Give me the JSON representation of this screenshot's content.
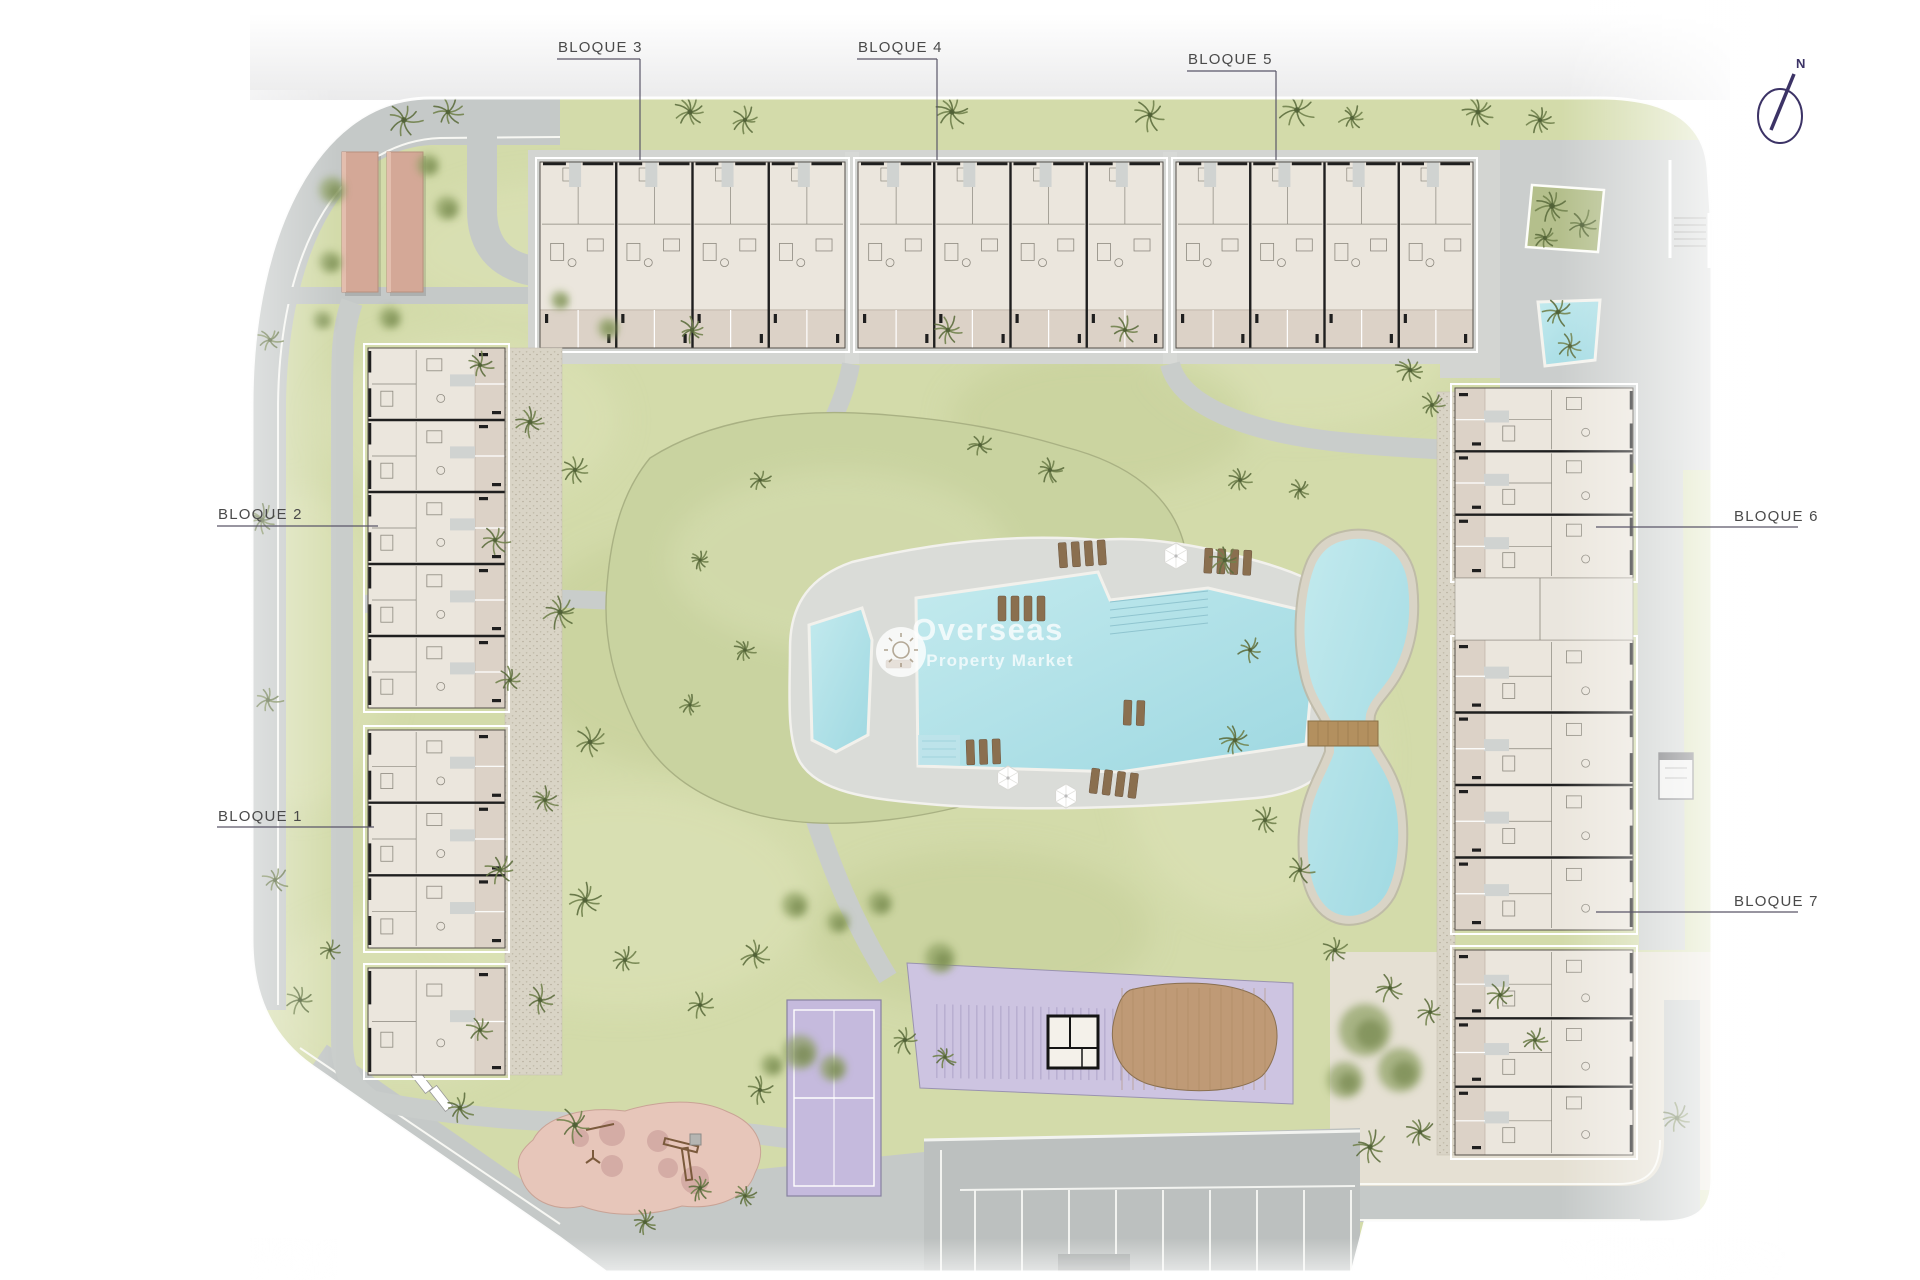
{
  "site_plan": {
    "title": "Residential development site plan",
    "block_labels": [
      {
        "id": "bloque-3",
        "text": "BLOQUE 3",
        "tx": 558,
        "ty": 52,
        "line": [
          557,
          59,
          640,
          59
        ],
        "drop": [
          640,
          59,
          640,
          160
        ]
      },
      {
        "id": "bloque-4",
        "text": "BLOQUE 4",
        "tx": 858,
        "ty": 52,
        "line": [
          857,
          59,
          937,
          59
        ],
        "drop": [
          937,
          59,
          937,
          160
        ]
      },
      {
        "id": "bloque-5",
        "text": "BLOQUE 5",
        "tx": 1188,
        "ty": 64,
        "line": [
          1187,
          71,
          1276,
          71
        ],
        "drop": [
          1276,
          71,
          1276,
          160
        ]
      },
      {
        "id": "bloque-2",
        "text": "BLOQUE 2",
        "tx": 218,
        "ty": 519,
        "line": [
          217,
          526,
          378,
          526
        ]
      },
      {
        "id": "bloque-1",
        "text": "BLOQUE 1",
        "tx": 218,
        "ty": 821,
        "line": [
          217,
          827,
          374,
          827
        ]
      },
      {
        "id": "bloque-6",
        "text": "BLOQUE 6",
        "tx": 1734,
        "ty": 521,
        "line": [
          1596,
          527,
          1798,
          527
        ]
      },
      {
        "id": "bloque-7",
        "text": "BLOQUE 7",
        "tx": 1734,
        "ty": 906,
        "line": [
          1596,
          912,
          1798,
          912
        ]
      }
    ],
    "compass": {
      "label": "N"
    },
    "watermark": {
      "title": "Overseas",
      "subtitle": "Property Market"
    },
    "features": [
      "main-pool",
      "kids-pool",
      "pool-deck",
      "central-lawn-mound",
      "lake",
      "lake-bridge",
      "tennis-court",
      "pergola-area",
      "pool-house",
      "petanque-area",
      "playground",
      "parking-lot",
      "carports",
      "plaza",
      "planter",
      "corner-pool",
      "stairs"
    ],
    "palette": {
      "lawn": "#d3dbaa",
      "lawn_light": "#dee4ba",
      "lawn_dark": "#c3cd96",
      "mound": "#c9d3a0",
      "road": "#c5c9c8",
      "road_light": "#d3d5d2",
      "apron": "#d3d5d2",
      "water_light": "#c3eaee",
      "water_deep": "#9ed8e1",
      "deck": "#dadcd8",
      "building_body": "#ebe6dd",
      "building_wall": "#1f1f1f",
      "terrace": "#dcd2c7",
      "stone": "#d9d4c6",
      "purple_court": "#c5badd",
      "purple_zone": "#cdc4e1",
      "petanque": "#bf9a76",
      "playground": "#e7c6ba",
      "playground_spot": "#cfa5a0",
      "carport": "#d4a897",
      "beige_paving": "#e5e0d3",
      "label_line": "#5a5668",
      "compass": "#3c3366",
      "tree": "#5f6f3f",
      "bridge": "#b3905f"
    }
  }
}
